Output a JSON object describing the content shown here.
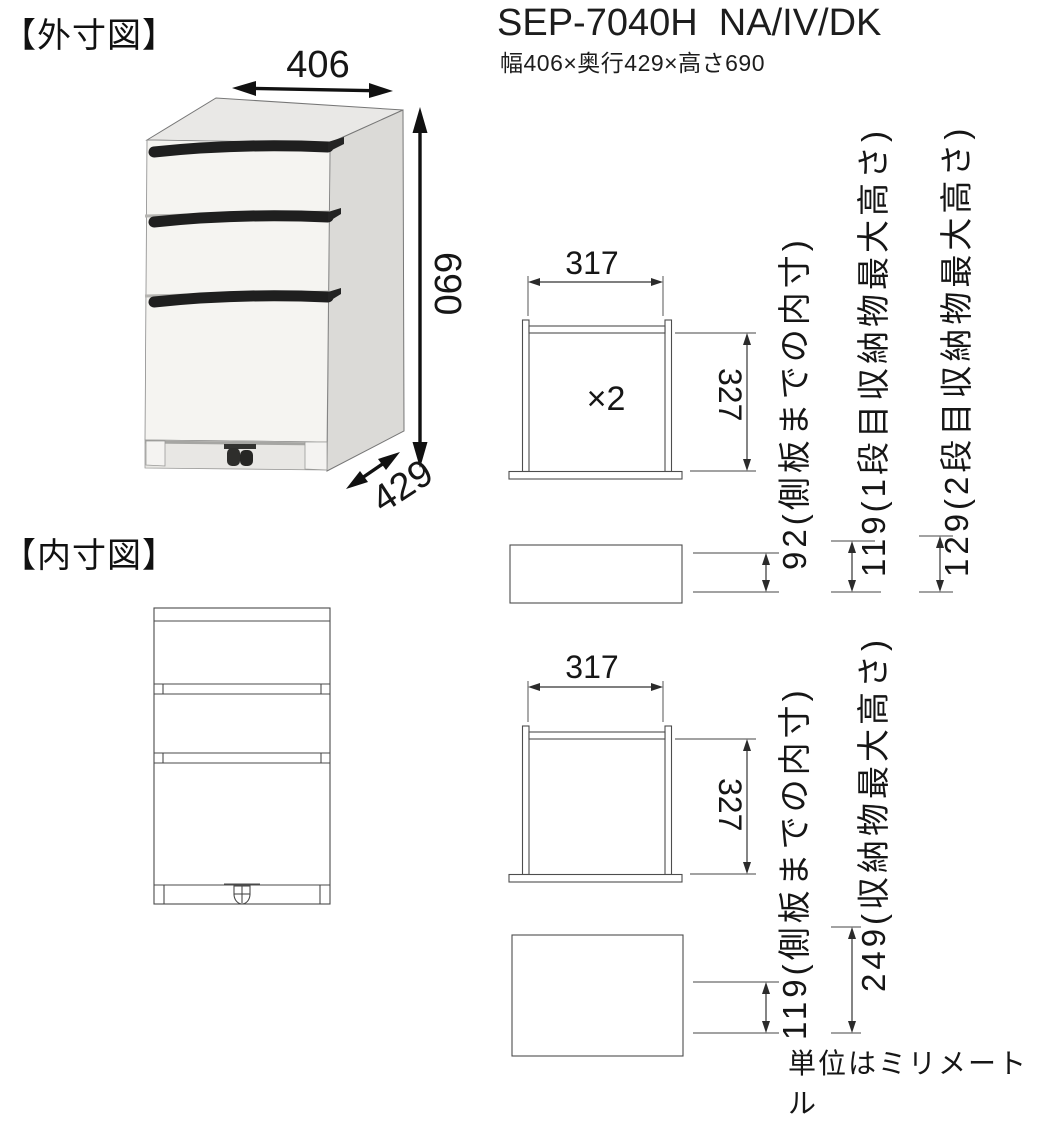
{
  "page": {
    "section_external_label": "【外寸図】",
    "section_internal_label": "【内寸図】",
    "title": "SEP-7040H  NA/IV/DK",
    "subtitle": "幅406×奥行429×高さ690",
    "unit_note": "単位はミリメートル"
  },
  "external_diagram": {
    "width": "406",
    "height": "690",
    "depth": "429"
  },
  "internal_top": {
    "width": "317",
    "height": "327",
    "multiplier": "×2",
    "inner_depth_label": "92(側板までの内寸)",
    "tier1_max_label": "119(1段目収納物最大高さ)",
    "tier2_max_label": "129(2段目収納物最大高さ)"
  },
  "internal_bottom": {
    "width": "317",
    "height": "327",
    "inner_depth_label": "119(側板までの内寸)",
    "max_height_label": "249(収納物最大高さ)"
  }
}
